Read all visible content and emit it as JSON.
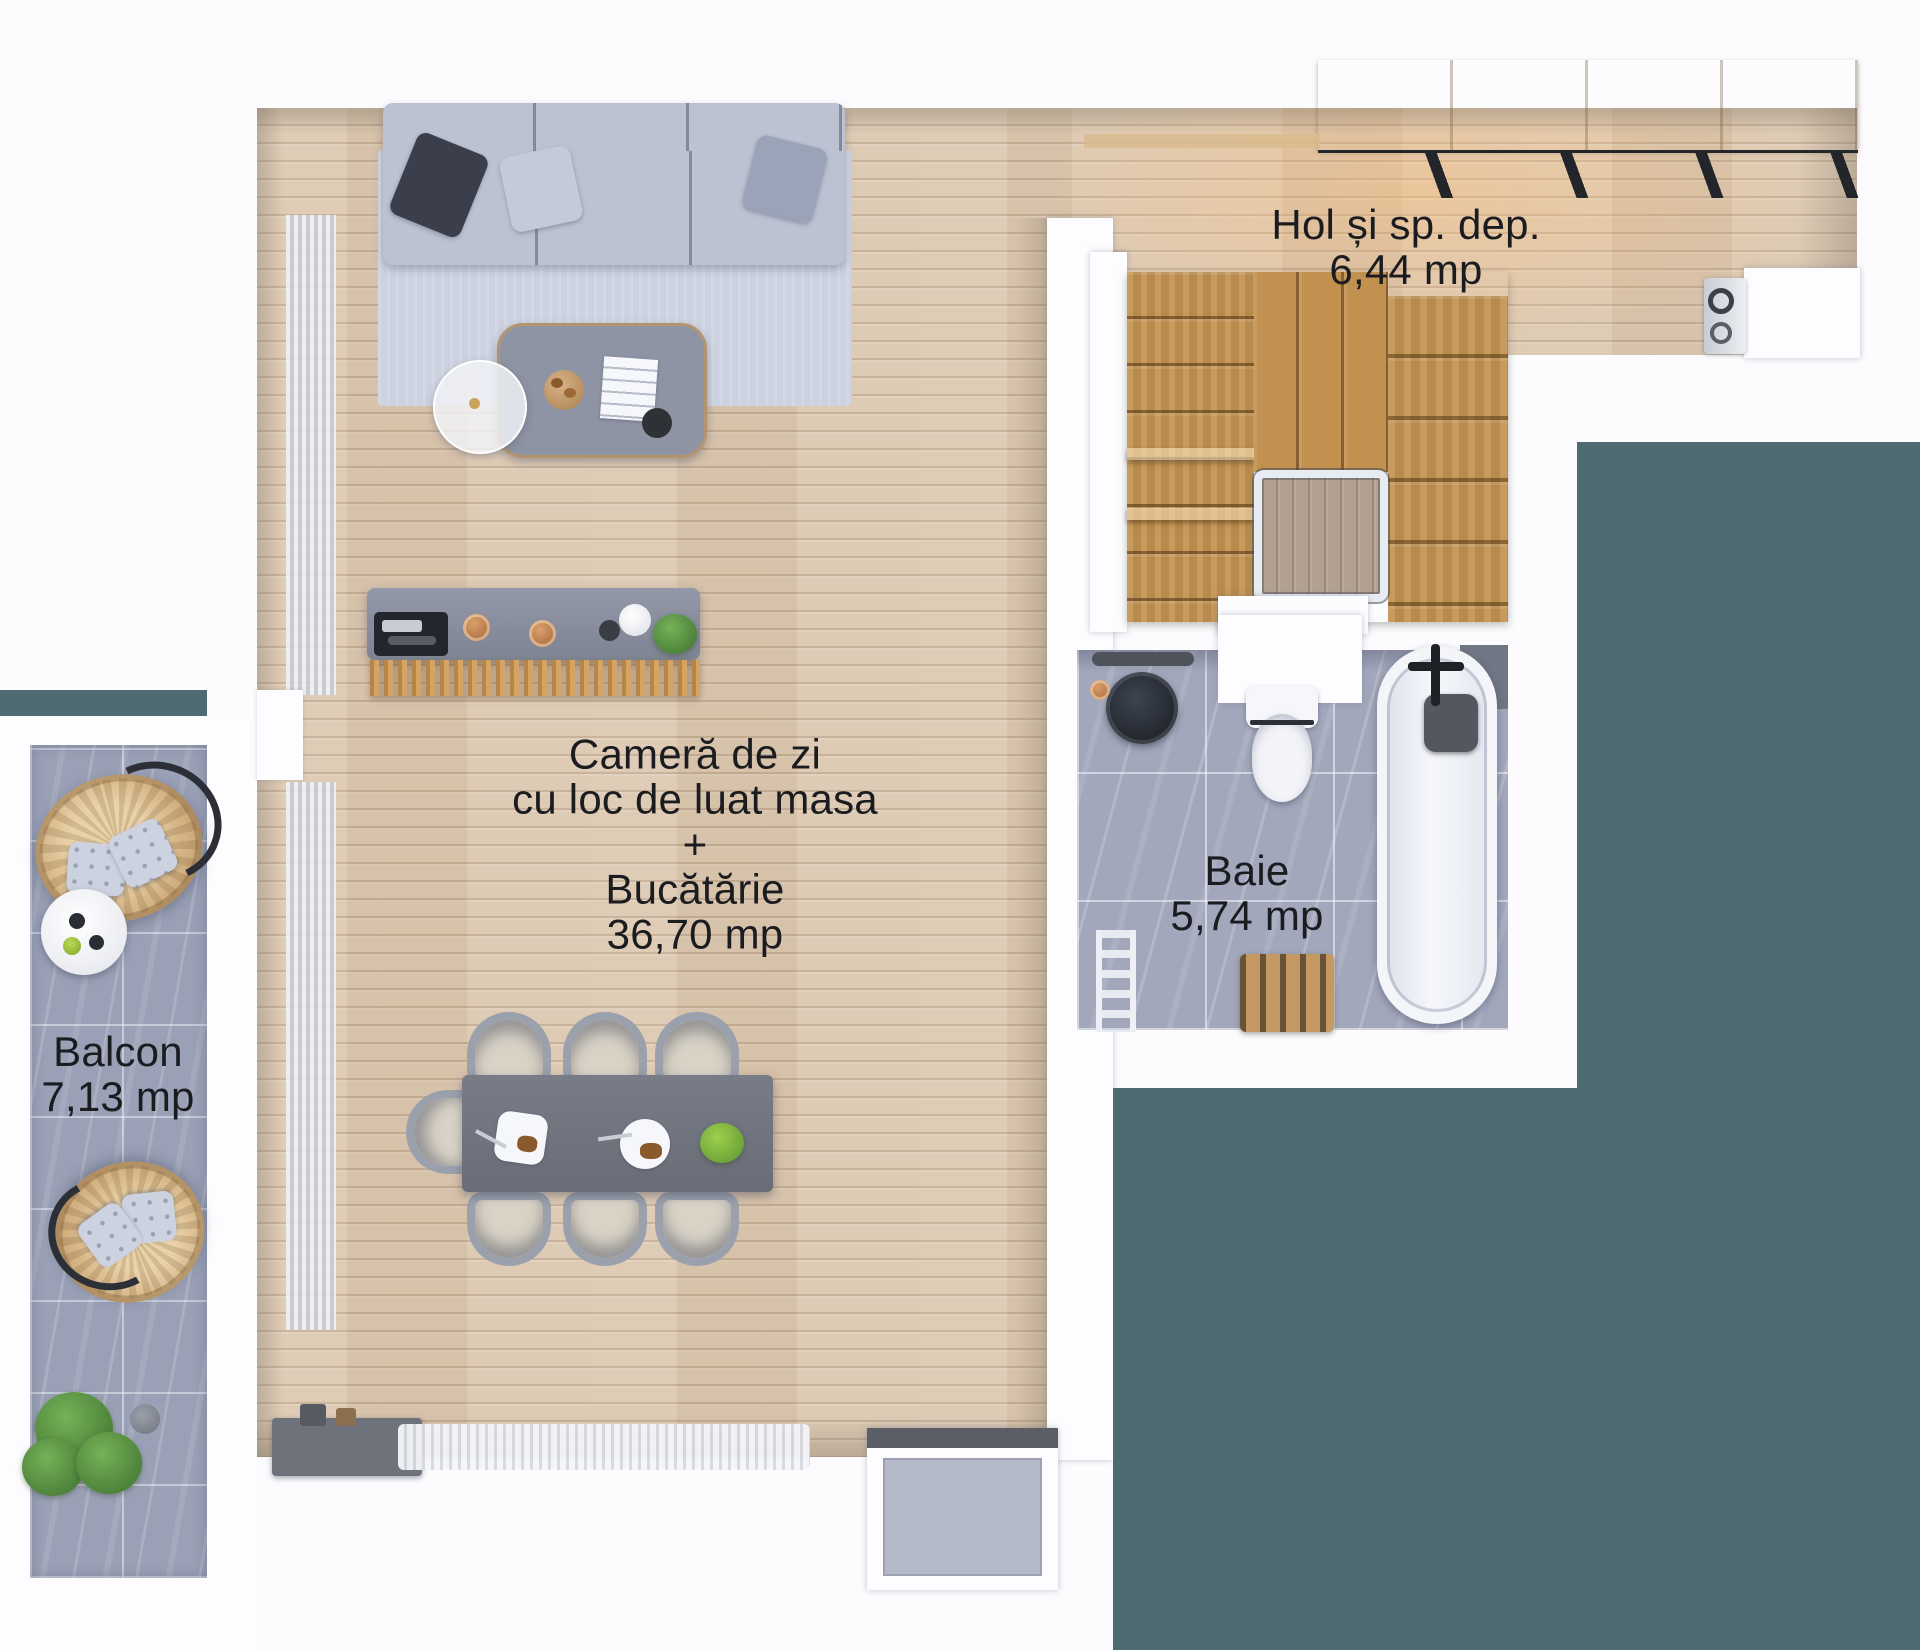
{
  "plan": {
    "type": "apartment-floor-plan-top-view",
    "rooms": [
      {
        "id": "hall",
        "label_lines": [
          "Hol și sp. dep.",
          "6,44 mp"
        ]
      },
      {
        "id": "living",
        "label_lines": [
          "Cameră de zi",
          "cu loc de luat masa",
          "+",
          "Bucătărie",
          "36,70 mp"
        ]
      },
      {
        "id": "bath",
        "label_lines": [
          "Baie",
          "5,74 mp"
        ]
      },
      {
        "id": "balcony",
        "label_lines": [
          "Balcon",
          "7,13 mp"
        ]
      }
    ],
    "furniture_icons": {
      "living": [
        "sofa",
        "rug",
        "coffee-table",
        "side-table",
        "curtains",
        "kitchen-bar",
        "bar-slats",
        "dining-table",
        "dining-chairs",
        "sideboard",
        "fringe-rug"
      ],
      "hall": [
        "wardrobe",
        "washing-machine",
        "staircase",
        "glass-railing"
      ],
      "bath": [
        "vessel-sink",
        "toilet",
        "bathtub",
        "faucet",
        "towel-ladder",
        "storage-crate"
      ],
      "balcony": [
        "hanging-egg-chair",
        "hanging-egg-chair",
        "round-table",
        "plant",
        "planter-pot"
      ],
      "exterior": [
        "ac-platform"
      ]
    },
    "palette": {
      "background_white": "#fcfcfe",
      "background_teal": "#4e6a72",
      "wood_floor": "#ddc9b2",
      "stair_wood": "#c2914f",
      "bath_tile": "#a2a7bb",
      "balcony_tile": "#9aa1b6",
      "label_text": "#1b1c20",
      "sofa": "#b9bfd0",
      "table_dark": "#71757e"
    }
  }
}
